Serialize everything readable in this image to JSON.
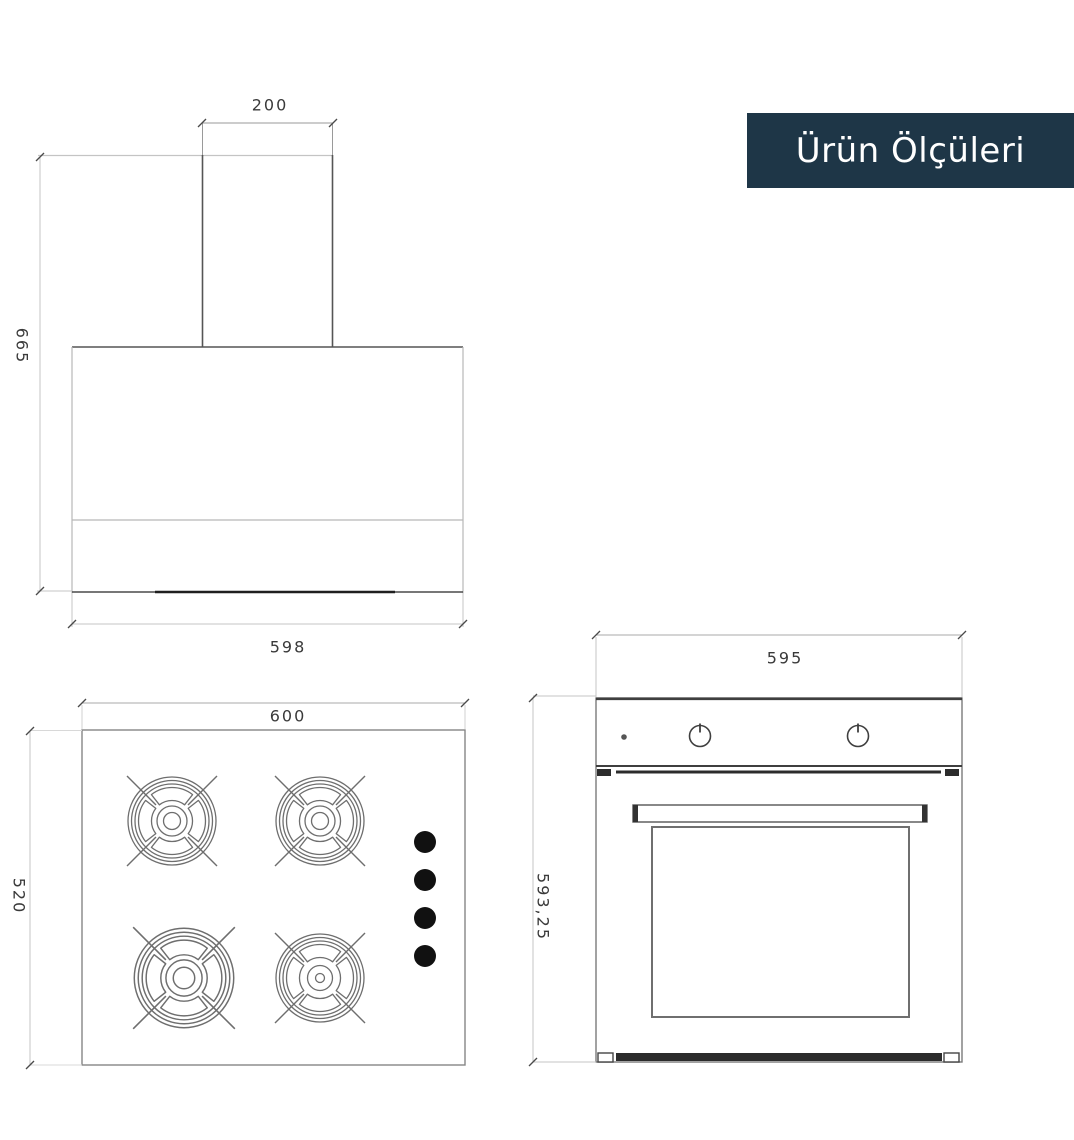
{
  "badge": {
    "label": "Ürün Ölçüleri"
  },
  "drawings": {
    "hood": {
      "chimney_width": "200",
      "height": "665",
      "width": "598"
    },
    "cooktop": {
      "width": "600",
      "depth": "520"
    },
    "oven": {
      "width": "595",
      "height": "593,25"
    }
  },
  "colors": {
    "badge_bg": "#1e3647",
    "badge_fg": "#ffffff",
    "line_dark": "#4a4a4a",
    "line_mid": "#8c8c8c",
    "line_light": "#c4c4c4",
    "knob_fill": "#111111"
  }
}
